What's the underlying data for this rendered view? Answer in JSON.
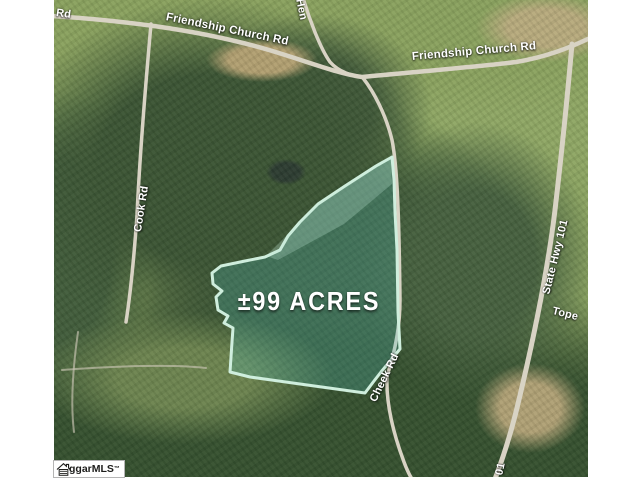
{
  "page": {
    "type": "real-estate-aerial-map",
    "background_color": "#ffffff"
  },
  "map": {
    "acreage_label": "±99 ACRES",
    "road_labels": {
      "rd_partial": "Rd",
      "friendship_church_rd_west": "Friendship Church Rd",
      "friendship_church_rd_east": "Friendship Church Rd",
      "hen_partial": "Hen",
      "cook_rd": "Cook Rd",
      "state_hwy_101": "State Hwy 101",
      "tope_partial": "Tope",
      "cheek_rd": "Cheek Rd",
      "hwy_101_partial": "01"
    },
    "parcel": {
      "outline_color": "#cfeedd",
      "fill_tint_color": "#4a7a6a",
      "label": "±99 ACRES"
    },
    "road_color": "#d8d3c4"
  },
  "watermark": {
    "text": "ggarMLS",
    "trademark": "™"
  }
}
